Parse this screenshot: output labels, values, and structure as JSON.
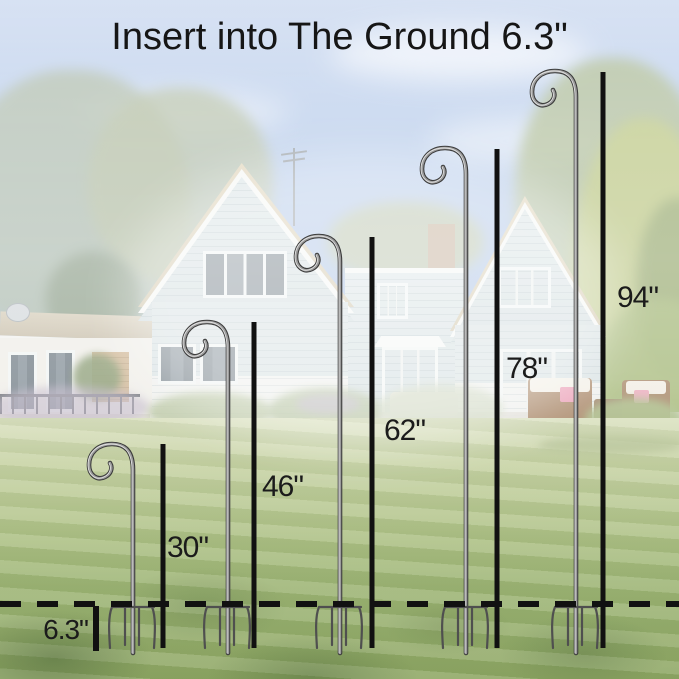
{
  "title": "Insert into The Ground 6.3\"",
  "diagram": {
    "type": "product-size-comparison",
    "product": "shepherd-hook-garden-stake",
    "unit": "inch",
    "ground_line_style": "dashed",
    "insert_depth": {
      "label": "6.3\"",
      "value_inches": 6.3
    },
    "hooks": [
      {
        "name": "shepherd-hook-30",
        "label": "30\"",
        "height_inches": 30
      },
      {
        "name": "shepherd-hook-46",
        "label": "46\"",
        "height_inches": 46
      },
      {
        "name": "shepherd-hook-62",
        "label": "62\"",
        "height_inches": 62
      },
      {
        "name": "shepherd-hook-78",
        "label": "78\"",
        "height_inches": 78
      },
      {
        "name": "shepherd-hook-94",
        "label": "94\"",
        "height_inches": 94
      }
    ]
  },
  "colors": {
    "annotation_black": "#141414",
    "metal_gray": "#8a8a8a",
    "sky_top": "#c6d5ee",
    "sky_mid": "#93b2de",
    "house_siding": "#cfdbdd",
    "house_trim": "#f3f5f2",
    "roof_tan": "#d9cbaa",
    "lawn_back": "#ccd5a8",
    "lawn_front": "#87a15a",
    "tree_yellow_green": "#b3c06e"
  }
}
